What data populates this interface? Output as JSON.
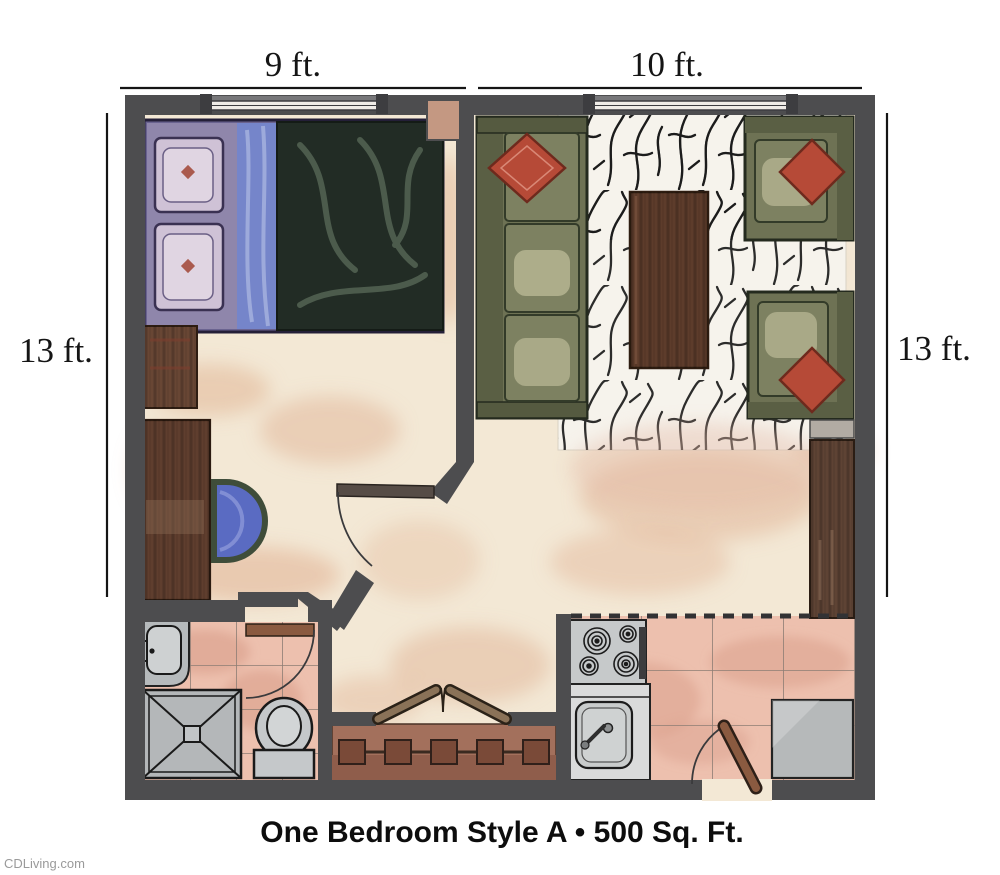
{
  "labels": {
    "dim_top_left": "9 ft.",
    "dim_top_right": "10 ft.",
    "dim_side_left": "13 ft.",
    "dim_side_right": "13 ft.",
    "caption": "One Bedroom Style A • 500 Sq. Ft.",
    "watermark": "CDLiving.com"
  },
  "plan": {
    "type": "apartment-floor-plan",
    "rooms_depicted": [
      "bedroom",
      "living-room",
      "bathroom",
      "kitchen",
      "closet",
      "entry-hall"
    ],
    "fixtures_depicted": [
      "bed",
      "nightstand",
      "desk",
      "desk-chair",
      "sofa",
      "two-armchairs",
      "coffee-table",
      "area-rug",
      "side-cabinet",
      "shelf",
      "vanity-sink",
      "shower",
      "toilet",
      "stove",
      "kitchen-sink",
      "refrigerator",
      "closet-rod-with-hangers",
      "bifold-doors",
      "entry-door",
      "bathroom-door",
      "bedroom-door",
      "windows"
    ]
  },
  "colors": {
    "wall": "#4d4d4f",
    "window_sill": "#77777a",
    "floor_cream": "#f3e8d5",
    "floor_blotch": "#e2b698",
    "tile_pink": "#edc0ae",
    "tile_grout": "#8d7d74",
    "rug_white": "#f6f3ec",
    "rug_ink": "#161616",
    "sofa_olive": "#6e7254",
    "sofa_back_olive": "#5a5f44",
    "sofa_frame": "#242a1e",
    "pillow_red": "#b64a37",
    "wood_cabinet": "#5e4334",
    "wood_desk": "#5f3e2e",
    "coffee_table": "#5d3c2b",
    "bed_blanket": "#222c25",
    "bed_sheet_blue": "#7585ca",
    "bed_pillow_lavender": "#cfc2d6",
    "desk_chair_blue": "#5a6bc2",
    "bath_fixture_gray": "#c5c8ca",
    "appliance_gray": "#b6b9ba",
    "closet_brown": "#a3705c",
    "door_wood": "#8a5a40",
    "dimension_text": "#151515",
    "caption_text": "#0d0d0d",
    "watermark_text": "#9a9a9a"
  }
}
